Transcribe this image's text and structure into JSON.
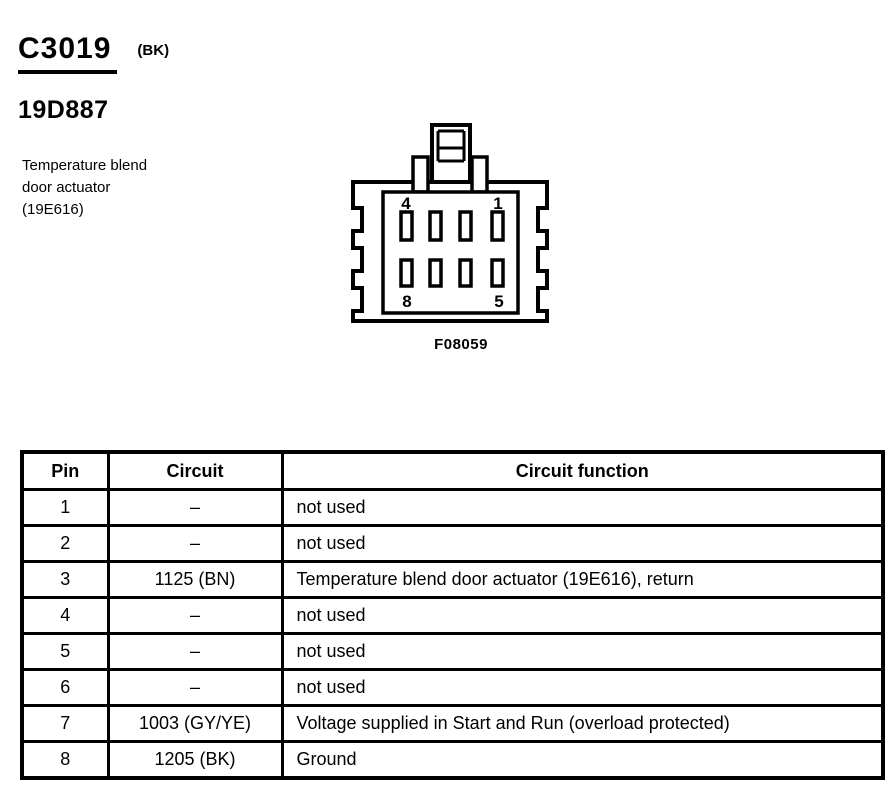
{
  "header": {
    "connector_id": "C3019",
    "color_code": "(BK)",
    "part_number": "19D887"
  },
  "component": {
    "name_lines": [
      "Temperature blend",
      "door actuator",
      "(19E616)"
    ]
  },
  "figure": {
    "caption": "F08059",
    "pin_labels": {
      "top_left": "4",
      "top_right": "1",
      "bottom_left": "8",
      "bottom_right": "5"
    }
  },
  "table": {
    "columns": [
      "Pin",
      "Circuit",
      "Circuit function"
    ],
    "rows": [
      {
        "pin": "1",
        "circuit": "–",
        "function": "not used"
      },
      {
        "pin": "2",
        "circuit": "–",
        "function": "not used"
      },
      {
        "pin": "3",
        "circuit": "1125 (BN)",
        "function": "Temperature blend door actuator (19E616), return"
      },
      {
        "pin": "4",
        "circuit": "–",
        "function": "not used"
      },
      {
        "pin": "5",
        "circuit": "–",
        "function": "not used"
      },
      {
        "pin": "6",
        "circuit": "–",
        "function": "not used"
      },
      {
        "pin": "7",
        "circuit": "1003 (GY/YE)",
        "function": "Voltage supplied in Start and Run (overload protected)"
      },
      {
        "pin": "8",
        "circuit": "1205 (BK)",
        "function": "Ground"
      }
    ]
  },
  "colors": {
    "ink": "#000000",
    "paper": "#ffffff"
  }
}
